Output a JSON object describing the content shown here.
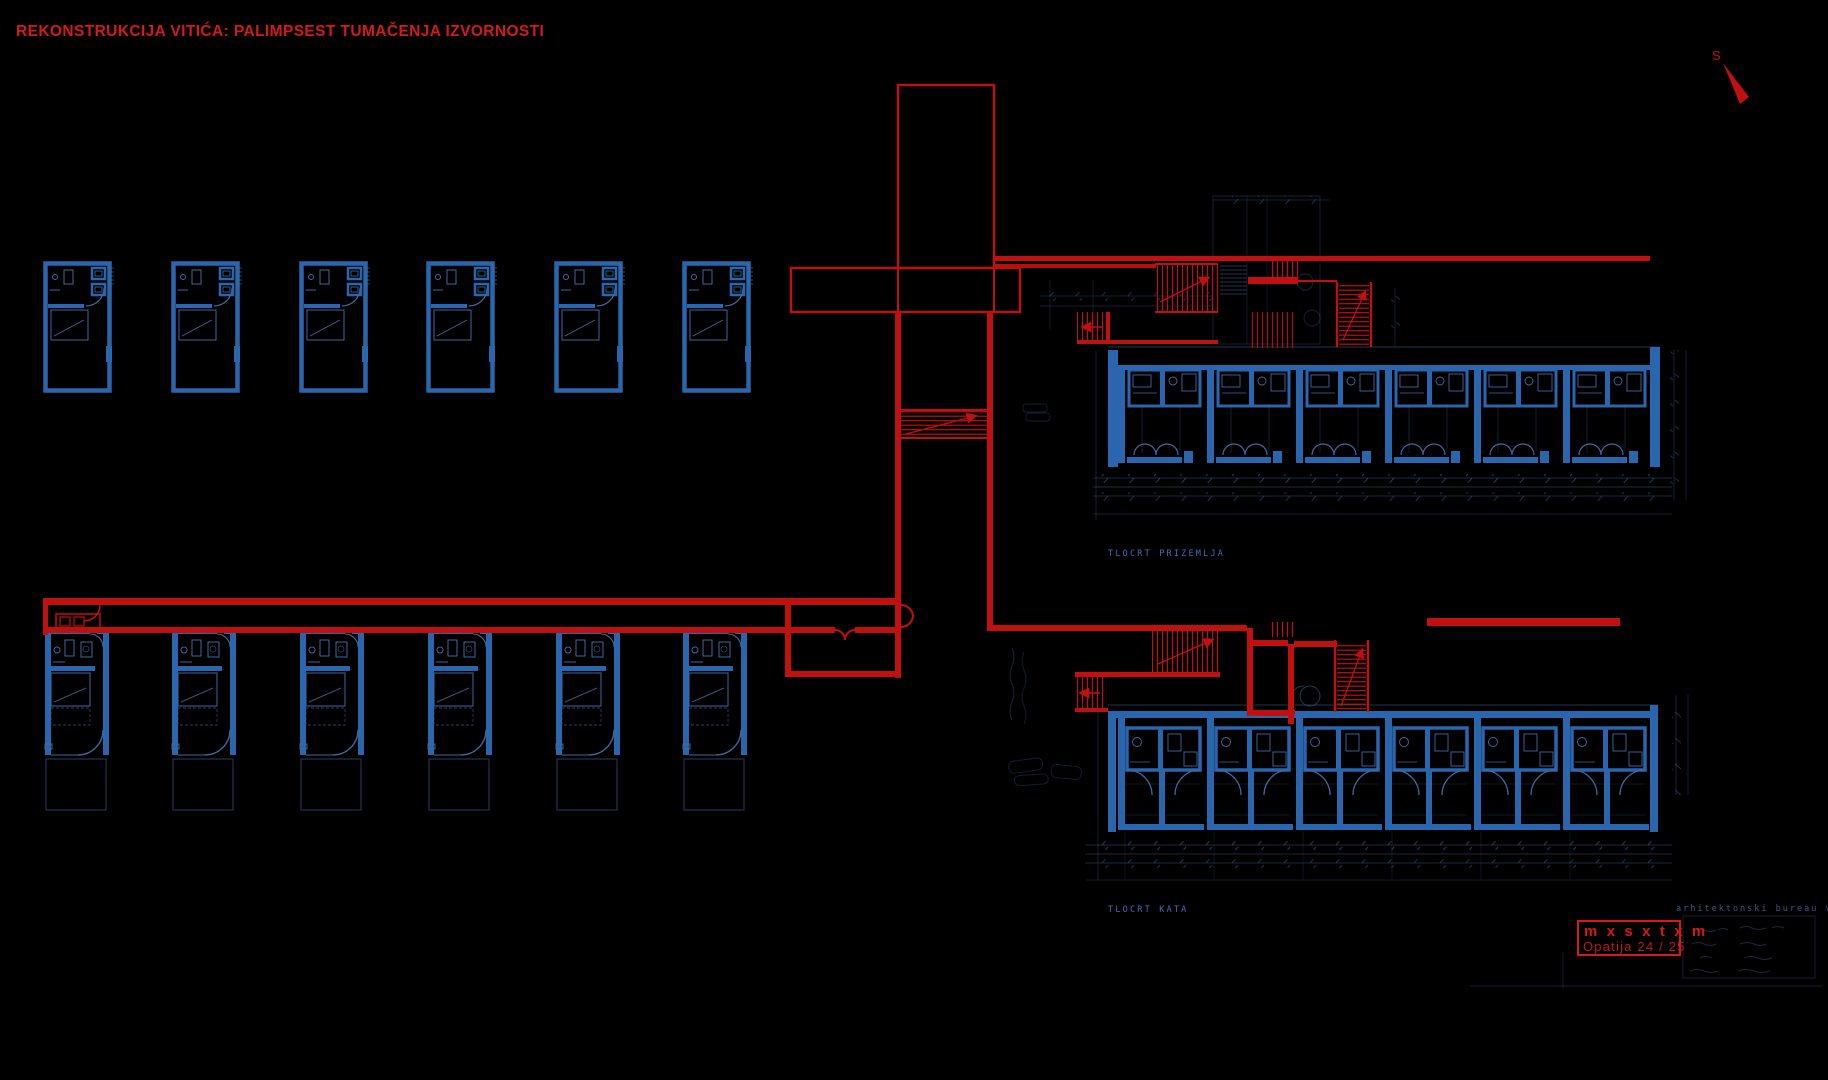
{
  "title": {
    "text": "REKONSTRUKCIJA VITIĆA: PALIMPSEST TUMAČENJA IZVORNOSTI"
  },
  "compass": {
    "label": "S"
  },
  "plans": {
    "upper_label": "TLOCRT PRIZEMLJA",
    "lower_label": "TLOCRT KATA"
  },
  "stamp": {
    "line1": "m x s x t x m",
    "line2": "Opatija  24 / 25"
  },
  "title_block": {
    "studio": "arhitektonski bureau vitić"
  },
  "colors": {
    "bg": "#000000",
    "blue": "#2a66ad",
    "blueFaint": "#40699f",
    "blueDim": "#2d4a74",
    "red": "#c11010",
    "red2": "#d31b1b"
  }
}
